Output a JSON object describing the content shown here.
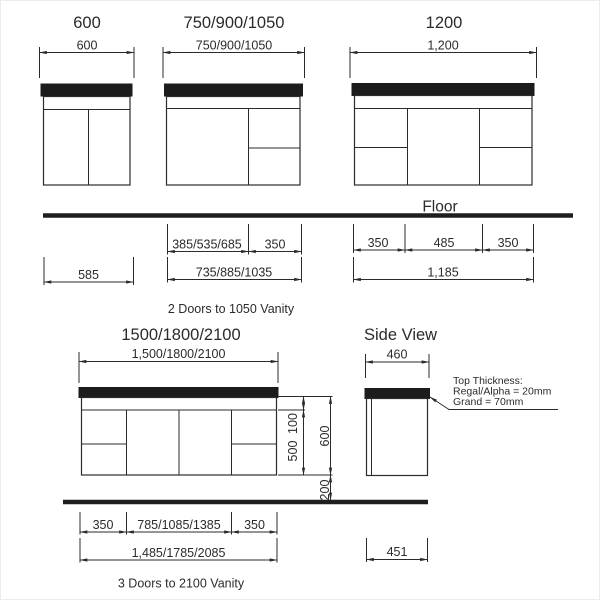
{
  "colors": {
    "ink": "#2b2b2b",
    "benchtop": "#1c1c1c",
    "background": "#ffffff"
  },
  "top_row": {
    "cab600": {
      "title": "600",
      "width_dim": "600"
    },
    "cab750": {
      "title": "750/900/1050",
      "width_dim": "750/900/1050"
    },
    "cab1200": {
      "title": "1200",
      "width_dim": "1,200"
    }
  },
  "floor": {
    "label": "Floor"
  },
  "under_floor_dims": {
    "cab600_total": "585",
    "cab750_door": "385/535/685",
    "cab750_drawers": "350",
    "cab750_total": "735/885/1035",
    "cab1200_left": "350",
    "cab1200_mid": "485",
    "cab1200_right": "350",
    "cab1200_total": "1,185"
  },
  "caption_top": "2 Doors to 1050 Vanity",
  "bottom_row": {
    "cab2100": {
      "title": "1500/1800/2100",
      "width_dim": "1,500/1800/2100"
    },
    "heights": {
      "top_rail": "100",
      "door": "500",
      "carcass": "600",
      "floor_gap": "200"
    },
    "under_dims": {
      "left": "350",
      "mid": "785/1085/1385",
      "right": "350",
      "total": "1,485/1785/2085"
    }
  },
  "side_view": {
    "title": "Side View",
    "top_width": "460",
    "bottom_width": "451",
    "note": {
      "line1": "Top Thickness:",
      "line2": "Regal/Alpha = 20mm",
      "line3": "Grand = 70mm"
    }
  },
  "caption_bottom": "3 Doors to 2100 Vanity"
}
